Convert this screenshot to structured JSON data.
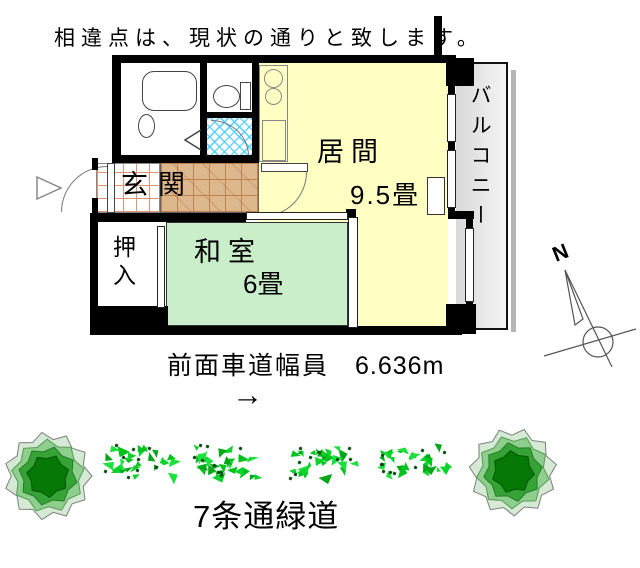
{
  "disclaimer": "相違点は、現状の通りと致します。",
  "plan": {
    "genkan_label": "玄関",
    "living_label": "居間",
    "living_size": "9.5畳",
    "washitsu_label": "和室",
    "washitsu_size": "6畳",
    "oshiire_label": "押入",
    "balcony_label": "バルコニー"
  },
  "compass": {
    "north_label": "N"
  },
  "road": {
    "label": "前面車道幅員",
    "value": "6.636m",
    "arrow": "→"
  },
  "greenway": {
    "label": "7条通緑道"
  },
  "colors": {
    "living": "#ffffc4",
    "washitsu": "#c9eec9",
    "genkan_tile": "#ddb88c",
    "balcony": "#e6e6e6",
    "hedge_green": "#00c21c",
    "bush_dark": "#067806"
  }
}
